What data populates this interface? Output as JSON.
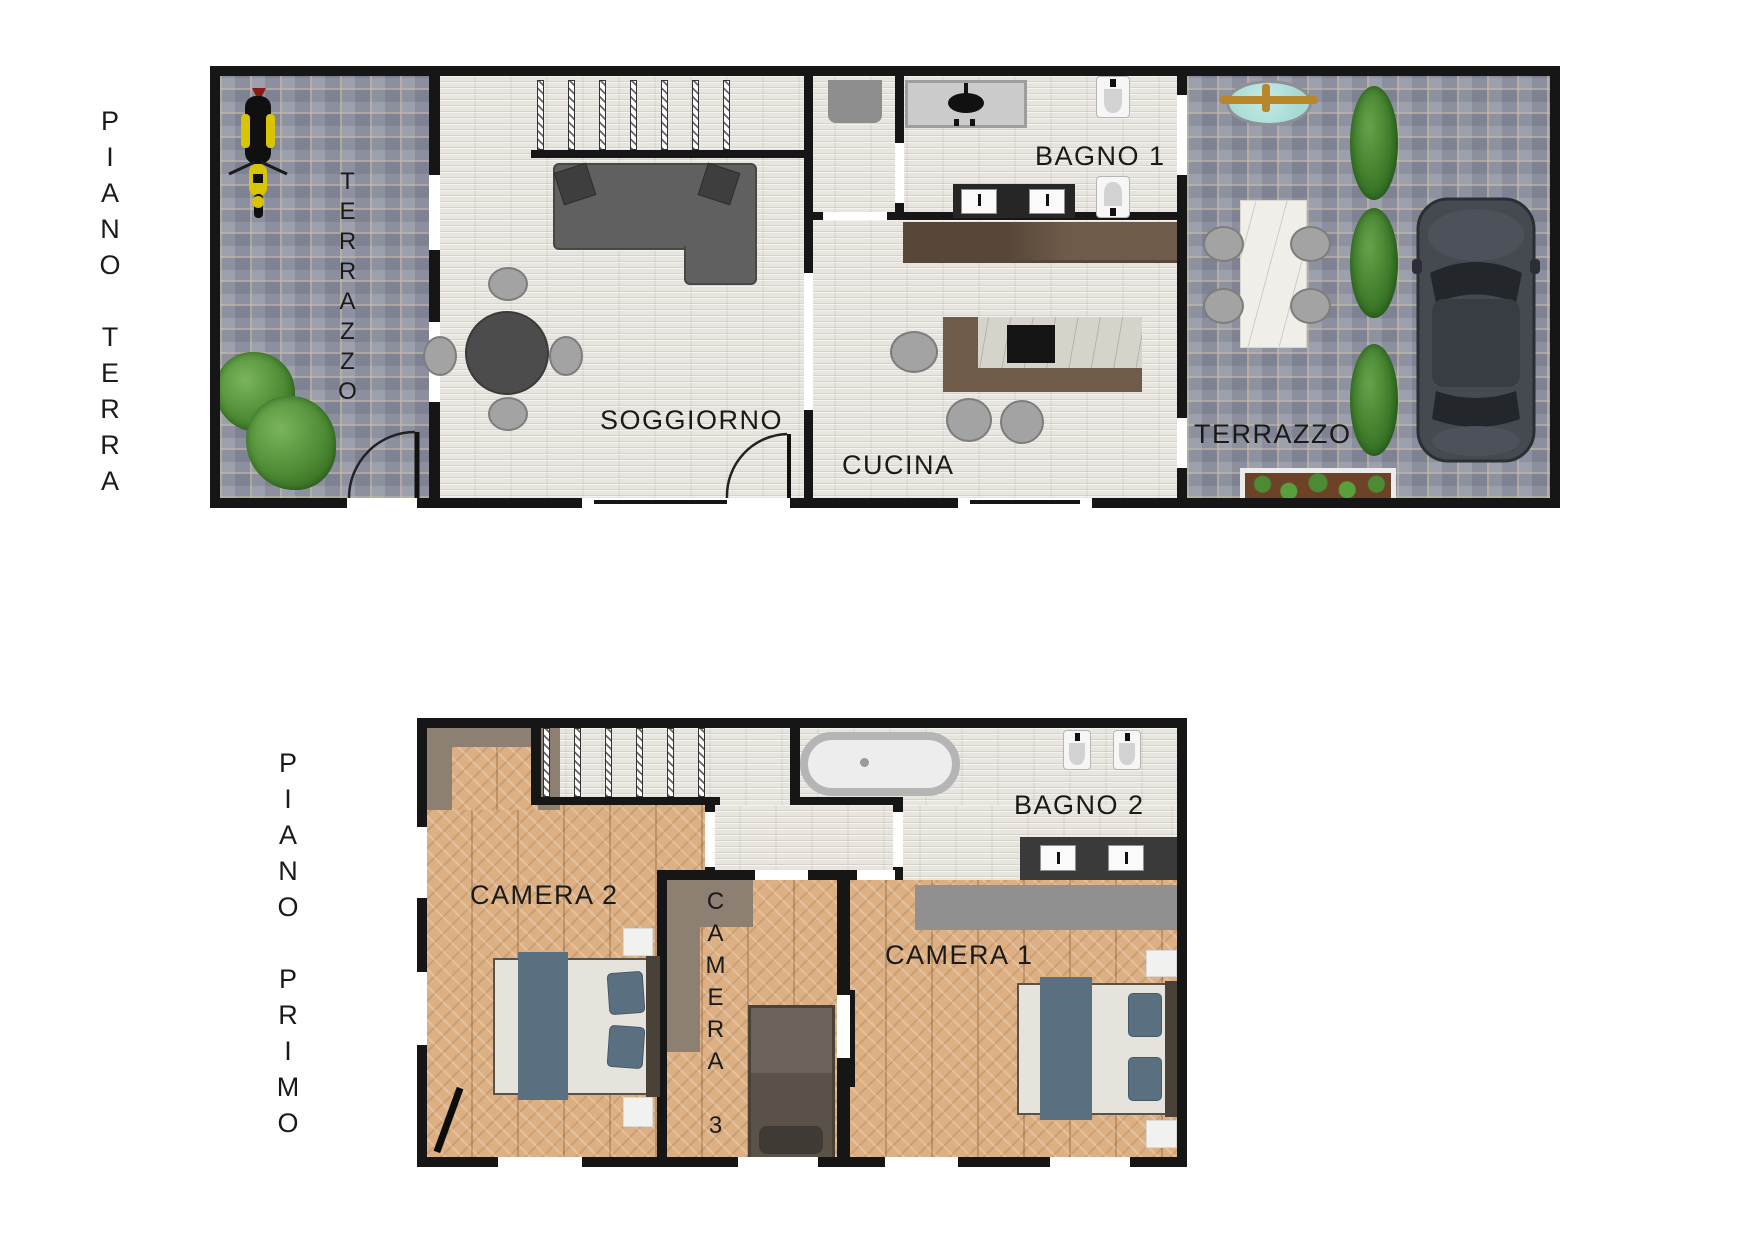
{
  "floors": {
    "ground": {
      "label": "PIANO TERRA",
      "rooms": {
        "terrazzo_left": "TERRAZZO",
        "soggiorno": "SOGGIORNO",
        "bagno1": "BAGNO 1",
        "cucina": "CUCINA",
        "terrazzo_right": "TERRAZZO"
      }
    },
    "first": {
      "label": "PIANO PRIMO",
      "rooms": {
        "camera2": "CAMERA 2",
        "camera3": "CAMERA 3",
        "camera1": "CAMERA 1",
        "bagno2": "BAGNO 2"
      }
    }
  },
  "palette": {
    "wall": "#161616",
    "label": "#1a1a1a",
    "parquet": "#dcb083",
    "stone": "#e8e5de",
    "cobble": "#9296a4",
    "taupe": "#8d8073",
    "sofa": "#606060",
    "blanket": "#5a7080",
    "counter": "#6f5b49",
    "bush_green": "#4c8a33",
    "fountain_teal": "#a6dad5",
    "car_body": "#454a51",
    "scooter_yellow": "#d8c400"
  }
}
